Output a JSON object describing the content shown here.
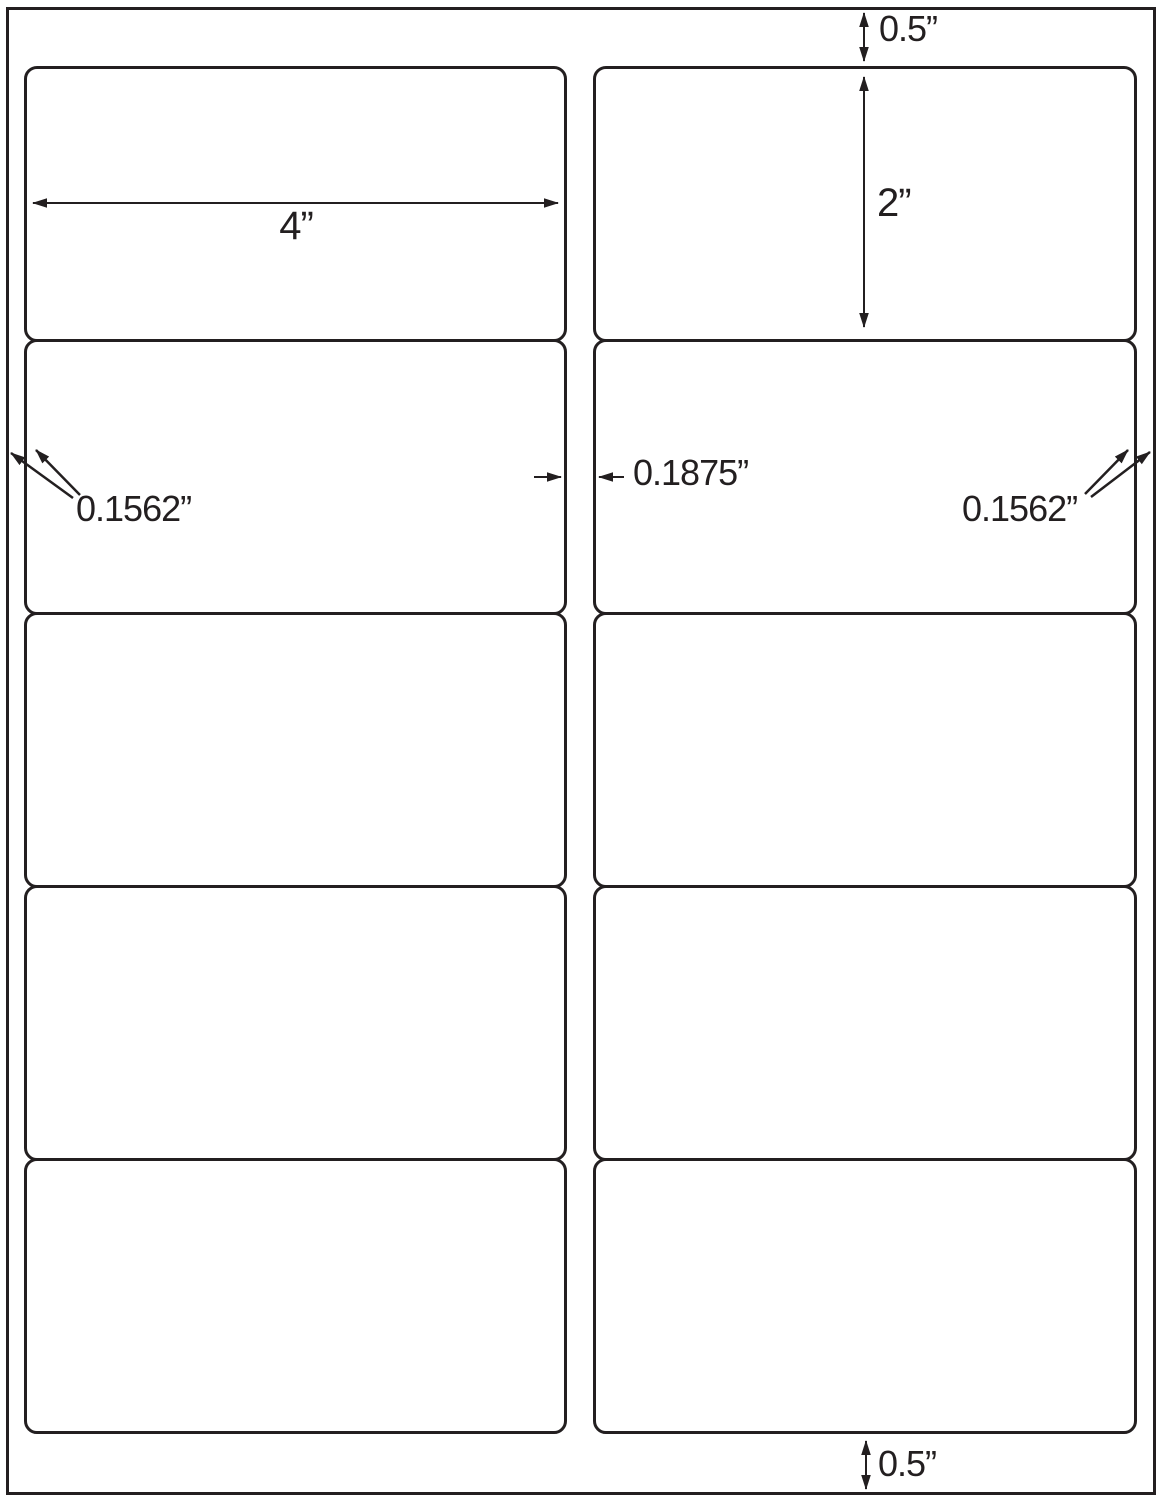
{
  "colors": {
    "ink": "#231f20",
    "paper": "#ffffff"
  },
  "sheet": {
    "rows": 5,
    "columns": 2
  },
  "annotations": {
    "top_margin": {
      "label": "0.5”"
    },
    "label_width": {
      "label": "4”"
    },
    "label_height": {
      "label": "2”"
    },
    "left_margin": {
      "label": "0.1562”"
    },
    "column_gap": {
      "label": "0.1875”"
    },
    "right_margin": {
      "label": "0.1562”"
    },
    "bottom_margin": {
      "label": "0.5”"
    }
  }
}
